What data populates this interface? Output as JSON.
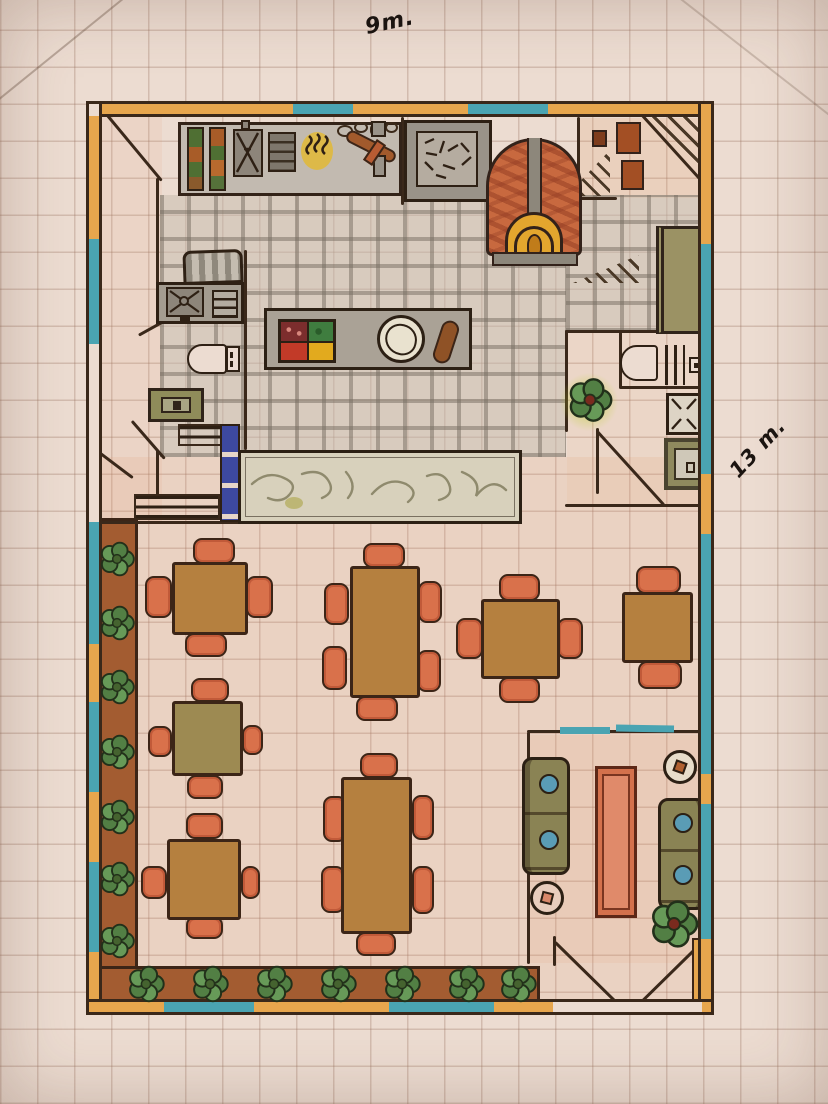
{
  "labels": {
    "top_dimension": "9m.",
    "right_dimension": "13 m."
  },
  "palette": {
    "paper": "#ecdcd1",
    "grid_line": "rgba(150,110,92,0.30)",
    "ink": "#3a281a",
    "wall_orange": "#e7a64d",
    "wall_teal": "#4aa4b2",
    "table_brown": "#b5803f",
    "table_olive": "#9d8a52",
    "chair_orange": "#d9714b",
    "planter_brown": "#a35c31",
    "leaf_green": "#5c8f50",
    "counter_gray": "#b9b1a5",
    "island_gray": "#aaa296",
    "bar_marble": "#d8d1bc",
    "oven_brick": "#c8693f",
    "flame_amber": "#e3a62e",
    "stair_blue": "#3d49a0",
    "sofa_olive": "#8a8354",
    "pillow_blue": "#5a9cb5",
    "coffee_table": "#d4714c"
  },
  "inventory": {
    "drawing": "hand-drawn restaurant floor plan on graph paper",
    "overall_width": "9m.",
    "overall_depth": "13 m.",
    "rooms": [
      "kitchen",
      "wood-fired oven",
      "storage room",
      "stairs",
      "wc",
      "restroom",
      "bar counter",
      "prep island",
      "dining area",
      "lounge",
      "entrance"
    ],
    "dining_tables": 7,
    "dining_chairs": 30,
    "sofas": 2,
    "round_side_tables": 2,
    "planters": 2
  },
  "dining_sets": [
    {
      "name": "square-4top-a",
      "table": {
        "x": 172,
        "y": 562,
        "w": 76,
        "h": 73,
        "color": "#b5803f"
      },
      "chairs": [
        [
          193,
          538,
          42,
          26
        ],
        [
          185,
          633,
          42,
          24
        ],
        [
          145,
          576,
          27,
          42
        ],
        [
          246,
          576,
          27,
          42
        ]
      ]
    },
    {
      "name": "rect-6top-a",
      "table": {
        "x": 350,
        "y": 566,
        "w": 70,
        "h": 132,
        "color": "#b5803f"
      },
      "chairs": [
        [
          363,
          543,
          42,
          25
        ],
        [
          356,
          696,
          42,
          25
        ],
        [
          324,
          583,
          25,
          42
        ],
        [
          322,
          646,
          25,
          44
        ],
        [
          418,
          581,
          24,
          42
        ],
        [
          417,
          650,
          24,
          42
        ]
      ]
    },
    {
      "name": "square-4top-b",
      "table": {
        "x": 481,
        "y": 599,
        "w": 79,
        "h": 80,
        "color": "#b5803f"
      },
      "chairs": [
        [
          499,
          574,
          41,
          27
        ],
        [
          499,
          677,
          41,
          26
        ],
        [
          456,
          618,
          27,
          41
        ],
        [
          557,
          618,
          26,
          41
        ]
      ]
    },
    {
      "name": "square-2top",
      "table": {
        "x": 622,
        "y": 592,
        "w": 71,
        "h": 71,
        "color": "#b5803f"
      },
      "chairs": [
        [
          636,
          566,
          45,
          28
        ],
        [
          638,
          661,
          44,
          28
        ]
      ]
    },
    {
      "name": "square-4top-olive",
      "table": {
        "x": 172,
        "y": 701,
        "w": 71,
        "h": 75,
        "color": "#9d8a52"
      },
      "chairs": [
        [
          191,
          678,
          38,
          24
        ],
        [
          148,
          726,
          24,
          31
        ],
        [
          242,
          725,
          21,
          30
        ],
        [
          187,
          775,
          36,
          24
        ]
      ]
    },
    {
      "name": "rect-6top-b",
      "table": {
        "x": 341,
        "y": 777,
        "w": 71,
        "h": 157,
        "color": "#b5803f"
      },
      "chairs": [
        [
          360,
          753,
          38,
          25
        ],
        [
          356,
          932,
          40,
          24
        ],
        [
          323,
          796,
          24,
          46
        ],
        [
          321,
          866,
          24,
          47
        ],
        [
          412,
          795,
          22,
          45
        ],
        [
          412,
          866,
          22,
          48
        ]
      ]
    },
    {
      "name": "square-4top-c",
      "table": {
        "x": 167,
        "y": 839,
        "w": 74,
        "h": 81,
        "color": "#b5803f"
      },
      "chairs": [
        [
          186,
          813,
          37,
          26
        ],
        [
          141,
          866,
          26,
          33
        ],
        [
          241,
          866,
          19,
          33
        ],
        [
          186,
          916,
          37,
          23
        ]
      ]
    }
  ],
  "flowers": {
    "left_planter_ys": [
      540,
      604,
      668,
      733,
      798,
      860,
      922
    ],
    "bottom_planter_xs": [
      126,
      190,
      254,
      318,
      382,
      446,
      498
    ]
  }
}
